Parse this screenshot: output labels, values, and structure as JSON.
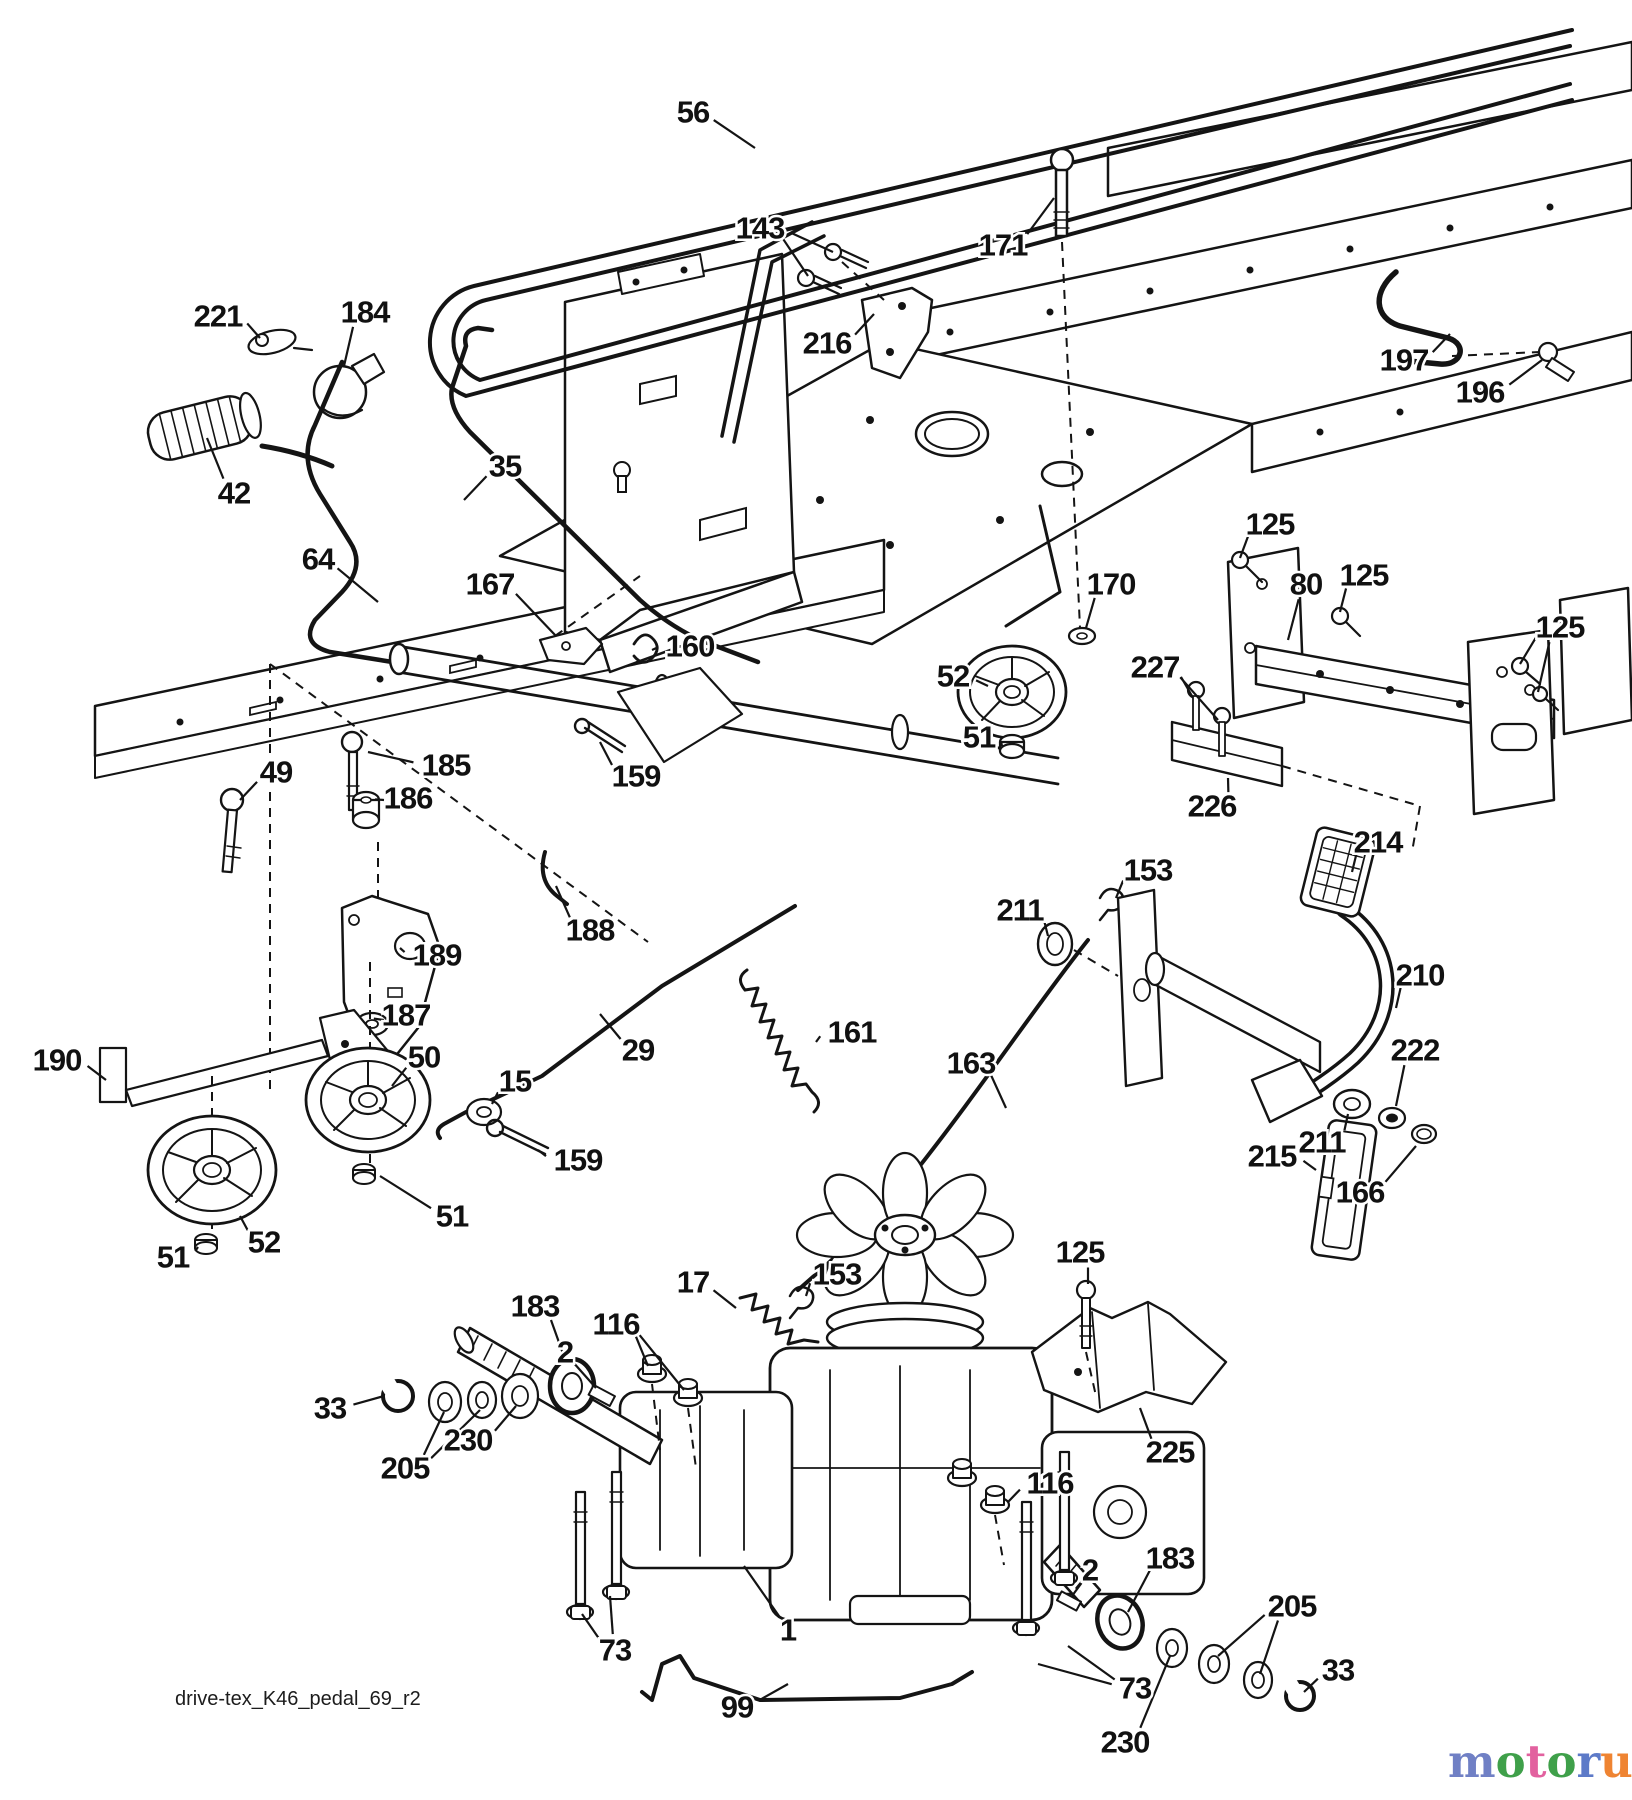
{
  "page": {
    "width": 1632,
    "height": 1800,
    "background": "#ffffff",
    "ink": "#141414"
  },
  "footer": {
    "drawing_code": "drive-tex_K46_pedal_69_r2"
  },
  "watermark": {
    "word": "motoruf",
    "tld": ".de",
    "tld_color": "#8d8d8d",
    "letters": [
      {
        "ch": "m",
        "color": "#7080c5"
      },
      {
        "ch": "o",
        "color": "#3fa04a"
      },
      {
        "ch": "t",
        "color": "#e2619f"
      },
      {
        "ch": "o",
        "color": "#3fa04a"
      },
      {
        "ch": "r",
        "color": "#5d7ac8"
      },
      {
        "ch": "u",
        "color": "#ef8432"
      },
      {
        "ch": "f",
        "color": "#e9a71f"
      }
    ]
  },
  "diagram": {
    "description": "Lawn tractor ground-drive exploded parts diagram (K46 transaxle, pedal control)",
    "labels": [
      {
        "t": "56",
        "x": 693,
        "y": 112,
        "leads": [
          [
            755,
            148
          ]
        ]
      },
      {
        "t": "143",
        "x": 760,
        "y": 228,
        "leads": [
          [
            833,
            252
          ],
          [
            808,
            276
          ]
        ]
      },
      {
        "t": "171",
        "x": 1003,
        "y": 245,
        "leads": [
          [
            1054,
            198
          ]
        ]
      },
      {
        "t": "216",
        "x": 827,
        "y": 343,
        "leads": [
          [
            874,
            314
          ]
        ]
      },
      {
        "t": "197",
        "x": 1404,
        "y": 360,
        "leads": [
          [
            1450,
            334
          ]
        ]
      },
      {
        "t": "196",
        "x": 1480,
        "y": 392,
        "leads": [
          [
            1542,
            360
          ]
        ]
      },
      {
        "t": "221",
        "x": 218,
        "y": 316,
        "leads": [
          [
            260,
            338
          ]
        ]
      },
      {
        "t": "184",
        "x": 365,
        "y": 312,
        "leads": [
          [
            344,
            366
          ]
        ]
      },
      {
        "t": "42",
        "x": 234,
        "y": 493,
        "leads": [
          [
            207,
            438
          ]
        ]
      },
      {
        "t": "35",
        "x": 505,
        "y": 466,
        "leads": [
          [
            464,
            500
          ]
        ]
      },
      {
        "t": "64",
        "x": 318,
        "y": 559,
        "leads": [
          [
            378,
            602
          ]
        ]
      },
      {
        "t": "167",
        "x": 490,
        "y": 584,
        "leads": [
          [
            556,
            636
          ]
        ]
      },
      {
        "t": "160",
        "x": 690,
        "y": 646,
        "leads": [
          [
            652,
            650
          ]
        ]
      },
      {
        "t": "125",
        "x": 1270,
        "y": 524,
        "leads": [
          [
            1240,
            558
          ]
        ]
      },
      {
        "t": "80",
        "x": 1306,
        "y": 584,
        "leads": [
          [
            1288,
            640
          ]
        ]
      },
      {
        "t": "125",
        "x": 1364,
        "y": 575,
        "leads": [
          [
            1340,
            612
          ]
        ]
      },
      {
        "t": "125",
        "x": 1560,
        "y": 627,
        "leads": [
          [
            1520,
            664
          ],
          [
            1538,
            692
          ]
        ]
      },
      {
        "t": "170",
        "x": 1111,
        "y": 584,
        "leads": [
          [
            1086,
            628
          ]
        ]
      },
      {
        "t": "52",
        "x": 953,
        "y": 676,
        "leads": [
          [
            988,
            686
          ]
        ]
      },
      {
        "t": "227",
        "x": 1155,
        "y": 667,
        "leads": [
          [
            1192,
            696
          ],
          [
            1218,
            720
          ]
        ]
      },
      {
        "t": "51",
        "x": 979,
        "y": 737,
        "leads": [
          [
            1002,
            746
          ]
        ]
      },
      {
        "t": "226",
        "x": 1212,
        "y": 806,
        "leads": [
          [
            1228,
            778
          ]
        ]
      },
      {
        "t": "49",
        "x": 276,
        "y": 772,
        "leads": [
          [
            240,
            800
          ]
        ]
      },
      {
        "t": "185",
        "x": 446,
        "y": 765,
        "leads": [
          [
            368,
            752
          ]
        ]
      },
      {
        "t": "186",
        "x": 408,
        "y": 798,
        "leads": [
          [
            384,
            800
          ]
        ]
      },
      {
        "t": "159",
        "x": 636,
        "y": 776,
        "leads": [
          [
            600,
            742
          ]
        ]
      },
      {
        "t": "188",
        "x": 590,
        "y": 930,
        "leads": [
          [
            556,
            886
          ]
        ]
      },
      {
        "t": "189",
        "x": 437,
        "y": 955,
        "leads": [
          [
            400,
            948
          ]
        ]
      },
      {
        "t": "187",
        "x": 406,
        "y": 1015,
        "leads": [
          [
            384,
            1020
          ]
        ]
      },
      {
        "t": "190",
        "x": 57,
        "y": 1060,
        "leads": [
          [
            106,
            1080
          ]
        ]
      },
      {
        "t": "50",
        "x": 424,
        "y": 1057,
        "leads": [
          [
            392,
            1086
          ]
        ]
      },
      {
        "t": "15",
        "x": 515,
        "y": 1081,
        "leads": [
          [
            492,
            1104
          ]
        ]
      },
      {
        "t": "29",
        "x": 638,
        "y": 1050,
        "leads": [
          [
            600,
            1014
          ]
        ]
      },
      {
        "t": "161",
        "x": 852,
        "y": 1032,
        "leads": [
          [
            816,
            1042
          ]
        ]
      },
      {
        "t": "163",
        "x": 971,
        "y": 1063,
        "leads": [
          [
            1006,
            1108
          ]
        ]
      },
      {
        "t": "153",
        "x": 1148,
        "y": 870,
        "leads": [
          [
            1116,
            898
          ]
        ]
      },
      {
        "t": "211",
        "x": 1020,
        "y": 910,
        "leads": [
          [
            1048,
            936
          ]
        ]
      },
      {
        "t": "214",
        "x": 1378,
        "y": 842,
        "leads": [
          [
            1352,
            872
          ]
        ]
      },
      {
        "t": "210",
        "x": 1420,
        "y": 975,
        "leads": [
          [
            1396,
            1008
          ]
        ]
      },
      {
        "t": "222",
        "x": 1415,
        "y": 1050,
        "leads": [
          [
            1396,
            1106
          ]
        ]
      },
      {
        "t": "215",
        "x": 1272,
        "y": 1156,
        "leads": [
          [
            1316,
            1170
          ]
        ]
      },
      {
        "t": "211",
        "x": 1322,
        "y": 1142,
        "leads": [
          [
            1348,
            1114
          ]
        ]
      },
      {
        "t": "166",
        "x": 1360,
        "y": 1192,
        "leads": [
          [
            1416,
            1146
          ]
        ]
      },
      {
        "t": "17",
        "x": 693,
        "y": 1282,
        "leads": [
          [
            736,
            1308
          ]
        ]
      },
      {
        "t": "153",
        "x": 837,
        "y": 1274,
        "leads": [
          [
            806,
            1296
          ]
        ]
      },
      {
        "t": "125",
        "x": 1080,
        "y": 1252,
        "leads": [
          [
            1088,
            1284
          ]
        ]
      },
      {
        "t": "183",
        "x": 535,
        "y": 1306,
        "leads": [
          [
            566,
            1362
          ]
        ]
      },
      {
        "t": "116",
        "x": 616,
        "y": 1324,
        "leads": [
          [
            648,
            1366
          ],
          [
            684,
            1390
          ]
        ]
      },
      {
        "t": "2",
        "x": 565,
        "y": 1352,
        "leads": [
          [
            596,
            1388
          ]
        ]
      },
      {
        "t": "33",
        "x": 330,
        "y": 1408,
        "leads": [
          [
            384,
            1396
          ]
        ]
      },
      {
        "t": "205",
        "x": 405,
        "y": 1468,
        "leads": [
          [
            444,
            1412
          ],
          [
            480,
            1410
          ]
        ]
      },
      {
        "t": "230",
        "x": 468,
        "y": 1440,
        "leads": [
          [
            516,
            1406
          ]
        ]
      },
      {
        "t": "225",
        "x": 1170,
        "y": 1452,
        "leads": [
          [
            1140,
            1408
          ]
        ]
      },
      {
        "t": "116",
        "x": 1050,
        "y": 1483,
        "leads": [
          [
            1008,
            1502
          ]
        ]
      },
      {
        "t": "2",
        "x": 1090,
        "y": 1570,
        "leads": [
          [
            1072,
            1596
          ]
        ]
      },
      {
        "t": "183",
        "x": 1170,
        "y": 1558,
        "leads": [
          [
            1128,
            1612
          ]
        ]
      },
      {
        "t": "205",
        "x": 1292,
        "y": 1606,
        "leads": [
          [
            1218,
            1656
          ],
          [
            1260,
            1674
          ]
        ]
      },
      {
        "t": "33",
        "x": 1338,
        "y": 1670,
        "leads": [
          [
            1304,
            1692
          ]
        ]
      },
      {
        "t": "230",
        "x": 1125,
        "y": 1742,
        "leads": [
          [
            1170,
            1656
          ]
        ]
      },
      {
        "t": "73",
        "x": 615,
        "y": 1650,
        "leads": [
          [
            582,
            1614
          ],
          [
            610,
            1596
          ]
        ]
      },
      {
        "t": "1",
        "x": 788,
        "y": 1630,
        "leads": [
          [
            744,
            1566
          ]
        ]
      },
      {
        "t": "99",
        "x": 737,
        "y": 1707,
        "leads": [
          [
            788,
            1684
          ]
        ]
      },
      {
        "t": "73",
        "x": 1135,
        "y": 1688,
        "leads": [
          [
            1068,
            1646
          ],
          [
            1038,
            1664
          ]
        ]
      },
      {
        "t": "51",
        "x": 452,
        "y": 1216,
        "leads": [
          [
            380,
            1176
          ]
        ]
      },
      {
        "t": "52",
        "x": 264,
        "y": 1242,
        "leads": [
          [
            240,
            1216
          ]
        ]
      },
      {
        "t": "51",
        "x": 173,
        "y": 1257,
        "leads": [
          [
            198,
            1247
          ]
        ]
      },
      {
        "t": "159",
        "x": 578,
        "y": 1160,
        "leads": [
          [
            538,
            1150
          ]
        ]
      }
    ]
  }
}
